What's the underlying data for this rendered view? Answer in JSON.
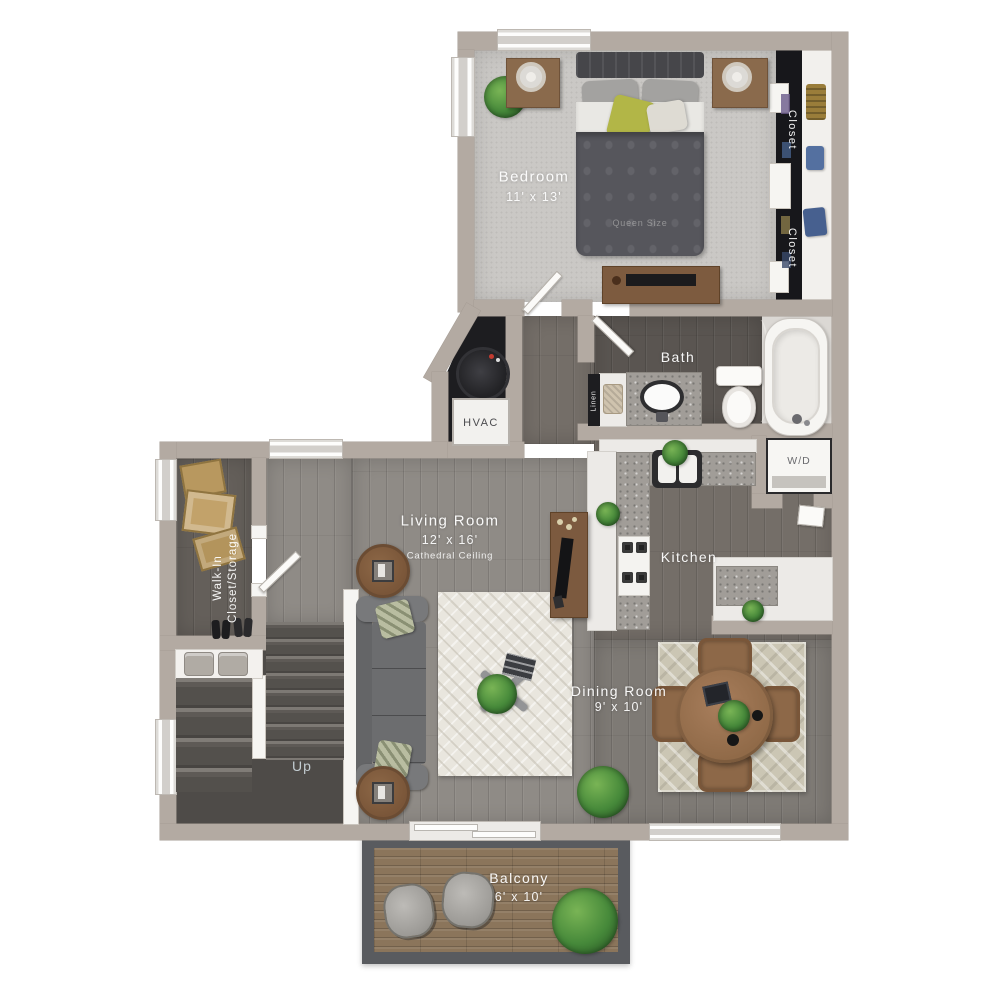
{
  "rooms": {
    "bedroom": {
      "name": "Bedroom",
      "dims": "11' x 13'",
      "bed_note": "Queen Size"
    },
    "closet_right_upper": {
      "name": "Closet"
    },
    "closet_right_lower": {
      "name": "Closet"
    },
    "bath": {
      "name": "Bath"
    },
    "linen": {
      "name": "Linen"
    },
    "hvac": {
      "name": "HVAC"
    },
    "laundry": {
      "name": "W/D"
    },
    "kitchen": {
      "name": "Kitchen"
    },
    "living": {
      "name": "Living Room",
      "dims": "12' x 16'",
      "note": "Cathedral Ceiling"
    },
    "walk_in": {
      "name": "Walk-In",
      "name_line2": "Closet/Storage"
    },
    "dining": {
      "name": "Dining Room",
      "dims": "9' x 10'"
    },
    "stairs": {
      "name": "Up"
    },
    "balcony": {
      "name": "Balcony",
      "dims": "6' x 10'"
    }
  },
  "colors": {
    "wall": "#b3aaa2",
    "bedroom_carpet": "#cac8c5",
    "closet_interior": "#17171b",
    "bath_floor": "#5a5551",
    "kitchen_floor": "#746e68",
    "living_floor": "#8f8b86",
    "dining_floor": "#7e7a75",
    "stair_carpet": "#54514d",
    "balcony_deck": "#8b755b",
    "granite_counter": "#a19d98",
    "living_rug": "#e9e6de",
    "dining_rug": "#cbc6b4",
    "accent_plant": "#46893a",
    "accent_pillow": "#b2b647",
    "label_text": "#ffffff"
  }
}
